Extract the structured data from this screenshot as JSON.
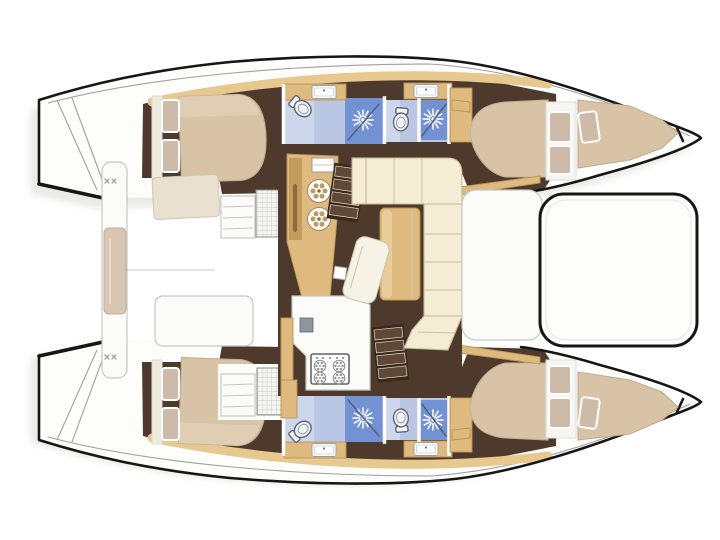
{
  "vessel": {
    "type": "sailing catamaran floor plan",
    "view": "top-down interior deck plan",
    "bow_direction": "right",
    "stern_direction": "left",
    "cabin_count": 4,
    "head_count": 4
  },
  "layout": {
    "top_hull": {
      "rooms": [
        "aft double cabin",
        "aft head with shower",
        "forward head with shower",
        "forward double cabin",
        "bow berth"
      ]
    },
    "bottom_hull": {
      "rooms": [
        "aft double cabin",
        "aft head with shower",
        "forward head with shower",
        "forward double cabin",
        "bow berth"
      ]
    },
    "bridgedeck": {
      "aft": [
        "transom swim platforms",
        "aft crossbeam with bench seat",
        "open cockpit"
      ],
      "salon": [
        "galley unit with twin round basins",
        "galley counter with 4-burner stove",
        "L-shaped settee",
        "dining table",
        "chaise seat",
        "companionway steps to each hull",
        "hatch gratings"
      ],
      "forward": [
        "forward cockpit seating pad"
      ]
    }
  },
  "icons": {
    "shower-drain-icon": "12-ray starburst",
    "burner-icon": "circle with spoke dots",
    "toilet-icon": "oval bowl with tank",
    "sink-icon": "rounded rectangle with faucet dot",
    "cleat-icon": "double x marks",
    "hatch-icon": "square grid grating",
    "steps-icon": "stacked treads"
  },
  "colors": {
    "background": "#ffffff",
    "outline": "#161616",
    "grayLine": "#a0a0a0",
    "softLine": "#c7c7c2",
    "deck": "#fdfdfc",
    "shadow": "#d9d9d4",
    "interior": "#4e3a2c",
    "stairDark": "#39291d",
    "stairTread": "#5f4936",
    "treadEdge": "#e3d8ca",
    "wood": "#dfba7e",
    "woodDark": "#bb9455",
    "woodLight": "#eed9ab",
    "trim": "#e7c88f",
    "mattress": "#d8c3a6",
    "mattressEdge": "#bfae92",
    "mattressLight": "#e8dac2",
    "pillow": "#cdbaa8",
    "sofa": "#f4ecd4",
    "sofaEdge": "#c8ba92",
    "whiteFurn": "#fbfbf9",
    "bath": "#b9c7e4",
    "bathLight": "#ccd7ec",
    "shower": "#7392d4",
    "glass": "#55607a",
    "fixture": "#f1f2f5",
    "fixtureEdge": "#606672",
    "metal": "#8e959e"
  }
}
